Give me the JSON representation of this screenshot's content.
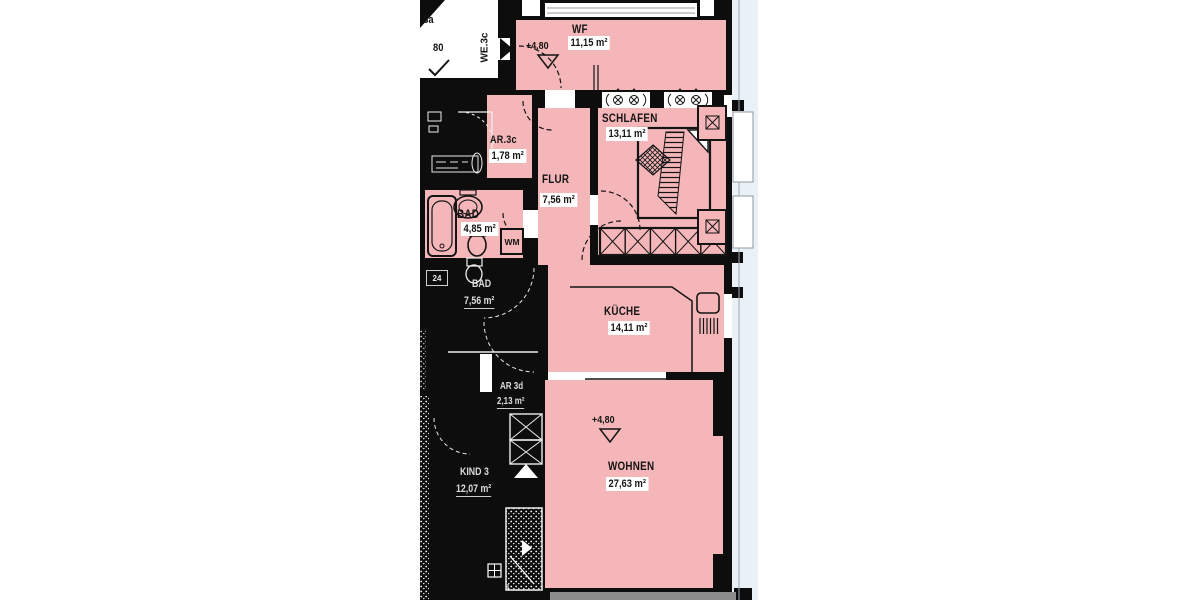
{
  "page": {
    "background": "#ffffff",
    "kind": "architectural floor plan"
  },
  "colors": {
    "room_fill": "#f4b6b8",
    "wall": "#0d0d0d",
    "balcony": "#e9f0f6",
    "paper": "#ffffff",
    "bottom_strip": "#8d8d8d"
  },
  "apartment": {
    "unit_label": "WE.3c",
    "level_marker": "+4,80",
    "rooms": [
      {
        "key": "wf",
        "name": "WF",
        "area": "11,15 m²"
      },
      {
        "key": "schlafen",
        "name": "SCHLAFEN",
        "area": "13,11 m²"
      },
      {
        "key": "ar",
        "name": "AR.3c",
        "area": "1,78 m²"
      },
      {
        "key": "flur",
        "name": "FLUR",
        "area": "7,56 m²"
      },
      {
        "key": "bad",
        "name": "BAD",
        "area": "4,85 m²"
      },
      {
        "key": "kueche",
        "name": "KÜCHE",
        "area": "14,11 m²"
      },
      {
        "key": "wohnen",
        "name": "WOHNEN",
        "area": "27,63 m²"
      }
    ],
    "washing_machine_label": "WM"
  },
  "surroundings": {
    "stairwell_unit_label": ":3a",
    "stairwell_level_label": "80",
    "neighbor_small_label": "24",
    "neighbor_rooms": [
      {
        "name": "BAD",
        "area": "7,56 m²"
      },
      {
        "name": "AR 3d",
        "area": "2,13 m²"
      },
      {
        "name": "KIND 3",
        "area": "12,07 m²"
      }
    ]
  }
}
